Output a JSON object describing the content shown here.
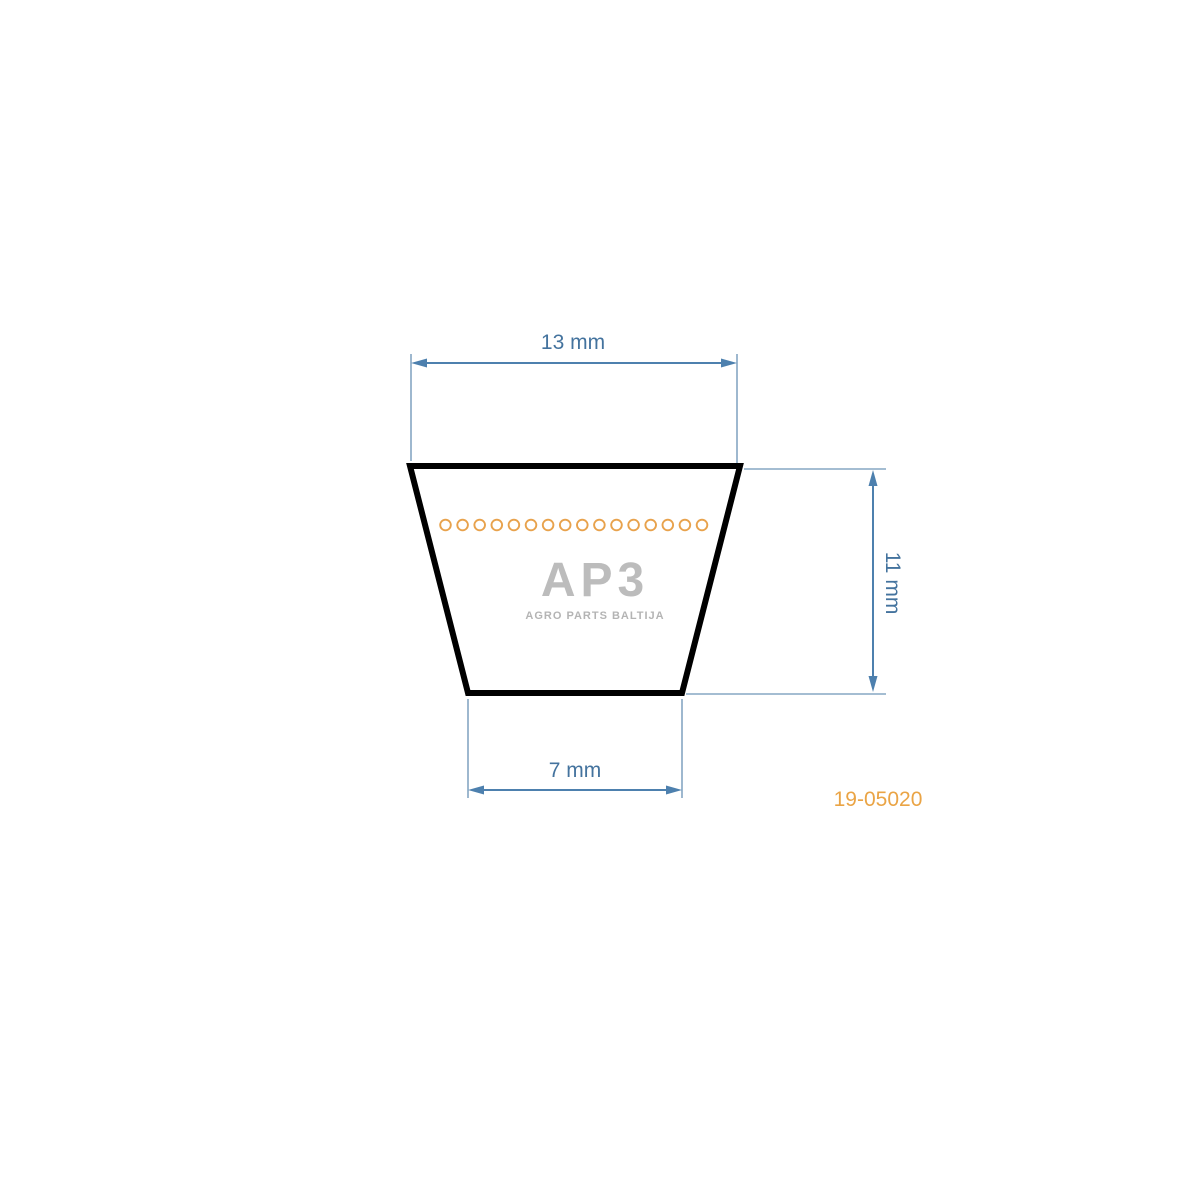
{
  "title": "V-belt cross-section dimensional diagram",
  "diagram": {
    "shape": "trapezoid belt cross-section",
    "top_width_label": "13 mm",
    "bottom_width_label": "7 mm",
    "height_label": "11 mm",
    "dimensions_mm": {
      "top_width": 13,
      "bottom_width": 7,
      "height": 11
    },
    "cord_circle_count": 16
  },
  "watermark": {
    "logo_text": "AP3",
    "subtitle": "AGRO PARTS BALTIJA"
  },
  "part_number": "19-05020",
  "colors": {
    "background": "#ffffff",
    "dimension_line": "#4d80ae",
    "extension_line": "#85a7c3",
    "dimension_text": "#44739e",
    "belt_outline": "#000000",
    "cord_circles": "#e8a24c",
    "part_number_text": "#eaa445",
    "watermark_gray": "#bcbcbc"
  }
}
